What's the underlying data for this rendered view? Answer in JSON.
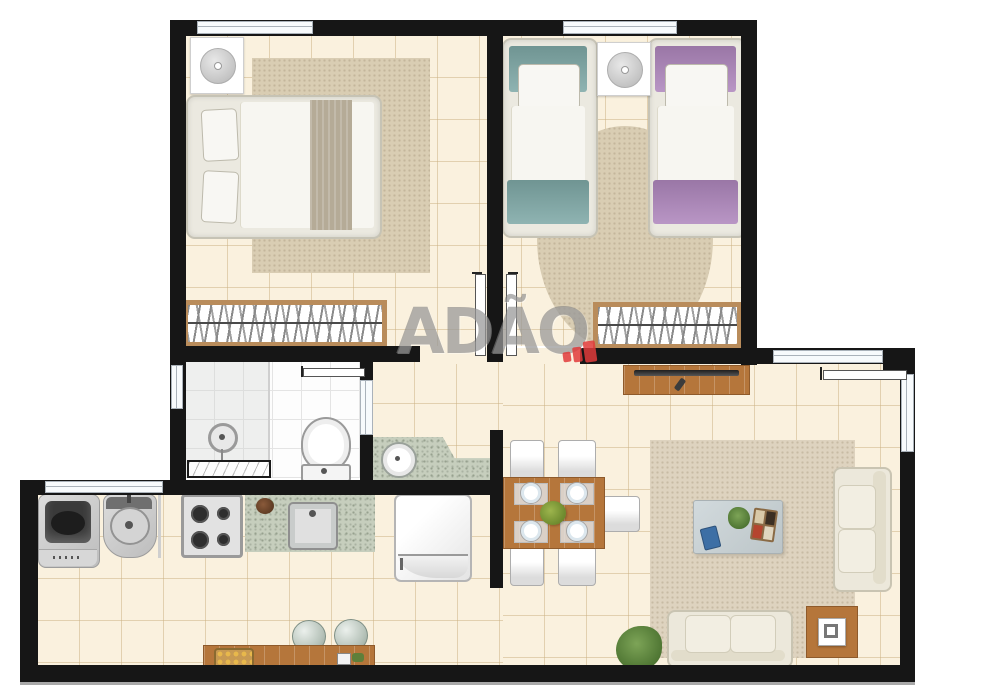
{
  "watermark": {
    "text": "ADÃO"
  },
  "colors": {
    "wall": "#161616",
    "floor": "#FAF1DE",
    "gridline": "rgba(203,176,128,0.5)",
    "bathfloor": "#FDFDFD",
    "bathgrid": "#E4E4E4",
    "rug": "#D9CDB3",
    "rug_living": "#DED3BF",
    "wood": "#B5763B",
    "wood_frame": "#B98C5B",
    "granite": "#C6CEBD",
    "teal": "#7FA9A7",
    "purple": "#AF87BD",
    "chair": "#DCDCDC",
    "sofa": "#ECE8DB",
    "window": "#F7FAFC",
    "red": "#E13B3B",
    "wm": "rgba(128,128,128,0.6)"
  },
  "rooms": {
    "bedroom_double": {
      "items": [
        "nightstand with lamp",
        "double bed",
        "area rug",
        "wardrobe"
      ]
    },
    "bedroom_twin": {
      "items": [
        "single bed teal",
        "single bed lilac",
        "nightstand with lamp",
        "round rug",
        "wardrobe"
      ]
    },
    "bathroom": {
      "items": [
        "shower head",
        "shower bench",
        "toilet",
        "vanity counter with round sink"
      ]
    },
    "kitchen_service": {
      "items": [
        "washing machine",
        "laundry tank",
        "stove 4 burners",
        "granite counter with sink",
        "refrigerator",
        "wooden bench",
        "fruit basket",
        "two stools"
      ]
    },
    "dining": {
      "items": [
        "wooden table",
        "five chairs",
        "four place settings",
        "fruit bowl"
      ]
    },
    "living": {
      "items": [
        "tv rack with tv and remote",
        "area rug",
        "coffee table with tablet plant and tray",
        "two-seat sofa right",
        "two-seat sofa bottom",
        "side table with lamp",
        "floor plant",
        "entry door"
      ]
    }
  }
}
